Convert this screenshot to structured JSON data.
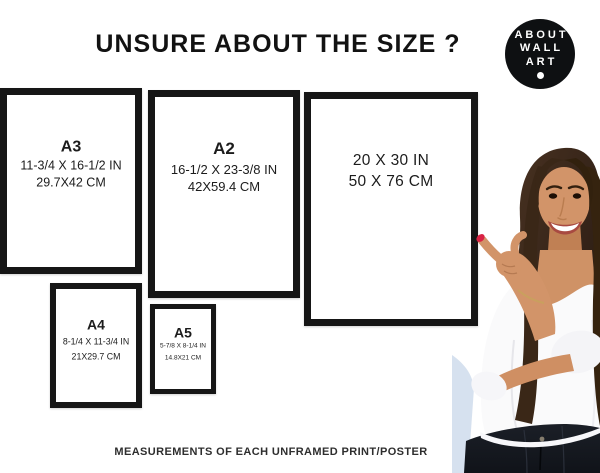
{
  "page": {
    "title": "UNSURE ABOUT THE SIZE ?",
    "footer": "MEASUREMENTS OF EACH UNFRAMED PRINT/POSTER"
  },
  "logo": {
    "line1": "ABOUT",
    "line2": "WALL",
    "line3": "ART"
  },
  "frames": [
    {
      "label": "A3",
      "inches": "11-3/4 X 16-1/2 IN",
      "cm": "29.7X42 CM"
    },
    {
      "label": "A2",
      "inches": "16-1/2 X 23-3/8 IN",
      "cm": "42X59.4 CM"
    },
    {
      "label": "",
      "inches": "20 X 30 IN",
      "cm": "50 X 76 CM"
    },
    {
      "label": "A4",
      "inches": "8-1/4 X 11-3/4 IN",
      "cm": "21X29.7 CM"
    },
    {
      "label": "A5",
      "inches": "5-7/8 X 8-1/4 IN",
      "cm": "14.8X21 CM"
    }
  ],
  "colors": {
    "frame_border": "#161616",
    "logo_background": "#0e1012",
    "title_text": "#121212",
    "nail_polish": "#d92244"
  }
}
